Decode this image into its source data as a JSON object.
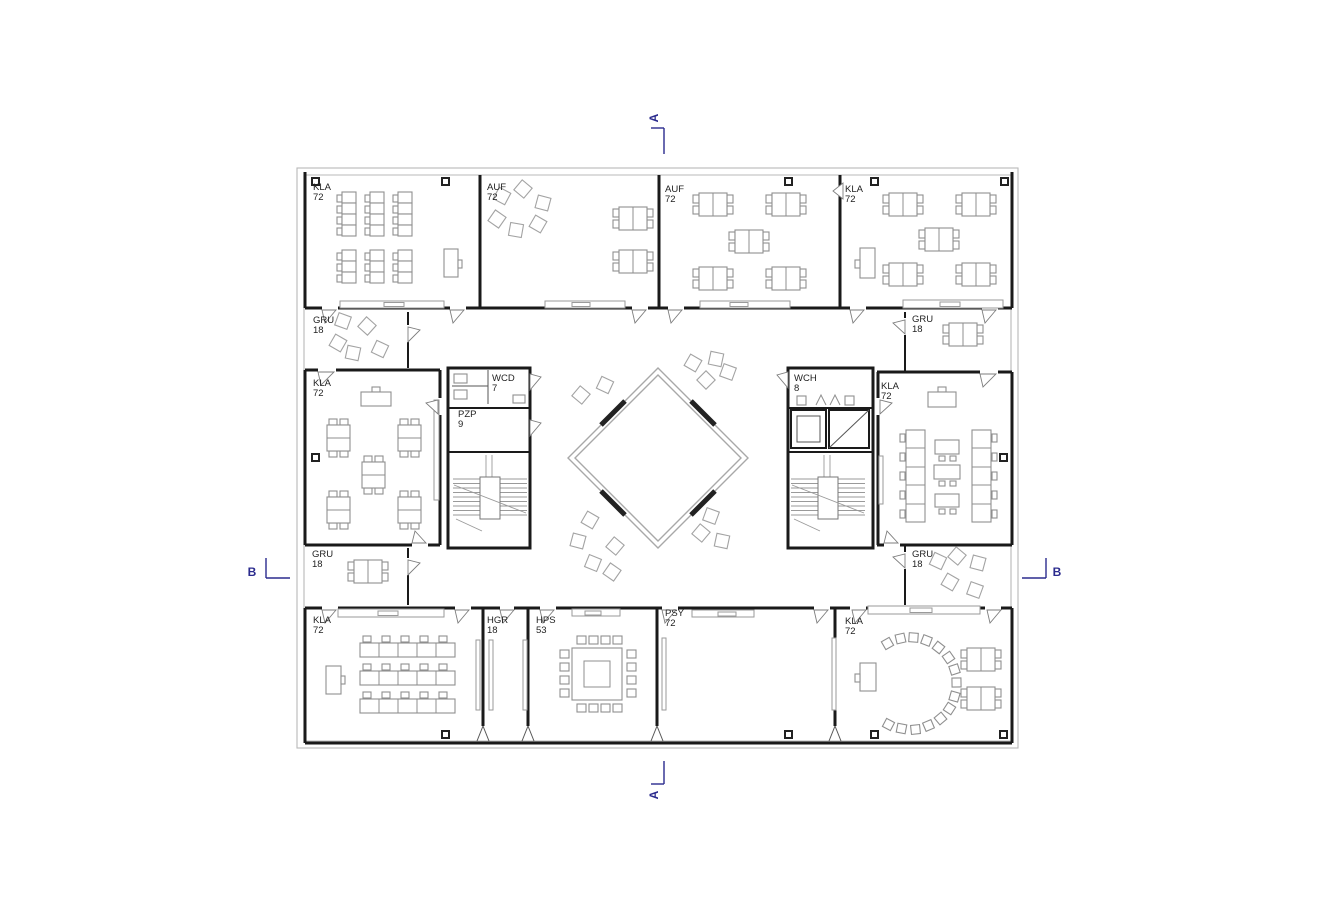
{
  "drawing": {
    "kind": "architectural floor plan",
    "colors": {
      "wall": "#1a1a1a",
      "facade": "#b9b9b9",
      "furniture": "#8f8f8f",
      "section_marker": "#2b2b8e",
      "background": "#ffffff"
    }
  },
  "sections": {
    "a_top": "A",
    "a_bottom": "A",
    "b_left": "B",
    "b_right": "B"
  },
  "rooms": [
    {
      "code": "KLA",
      "area": "72"
    },
    {
      "code": "AUF",
      "area": "72"
    },
    {
      "code": "AUF",
      "area": "72"
    },
    {
      "code": "KLA",
      "area": "72"
    },
    {
      "code": "GRU",
      "area": "18"
    },
    {
      "code": "GRU",
      "area": "18"
    },
    {
      "code": "KLA",
      "area": "72"
    },
    {
      "code": "WCD",
      "area": "7"
    },
    {
      "code": "PZP",
      "area": "9"
    },
    {
      "code": "WCH",
      "area": "8"
    },
    {
      "code": "KLA",
      "area": "72"
    },
    {
      "code": "GRU",
      "area": "18"
    },
    {
      "code": "GRU",
      "area": "18"
    },
    {
      "code": "KLA",
      "area": "72"
    },
    {
      "code": "HGR",
      "area": "18"
    },
    {
      "code": "HPS",
      "area": "53"
    },
    {
      "code": "PSY",
      "area": "72"
    },
    {
      "code": "KLA",
      "area": "72"
    }
  ]
}
